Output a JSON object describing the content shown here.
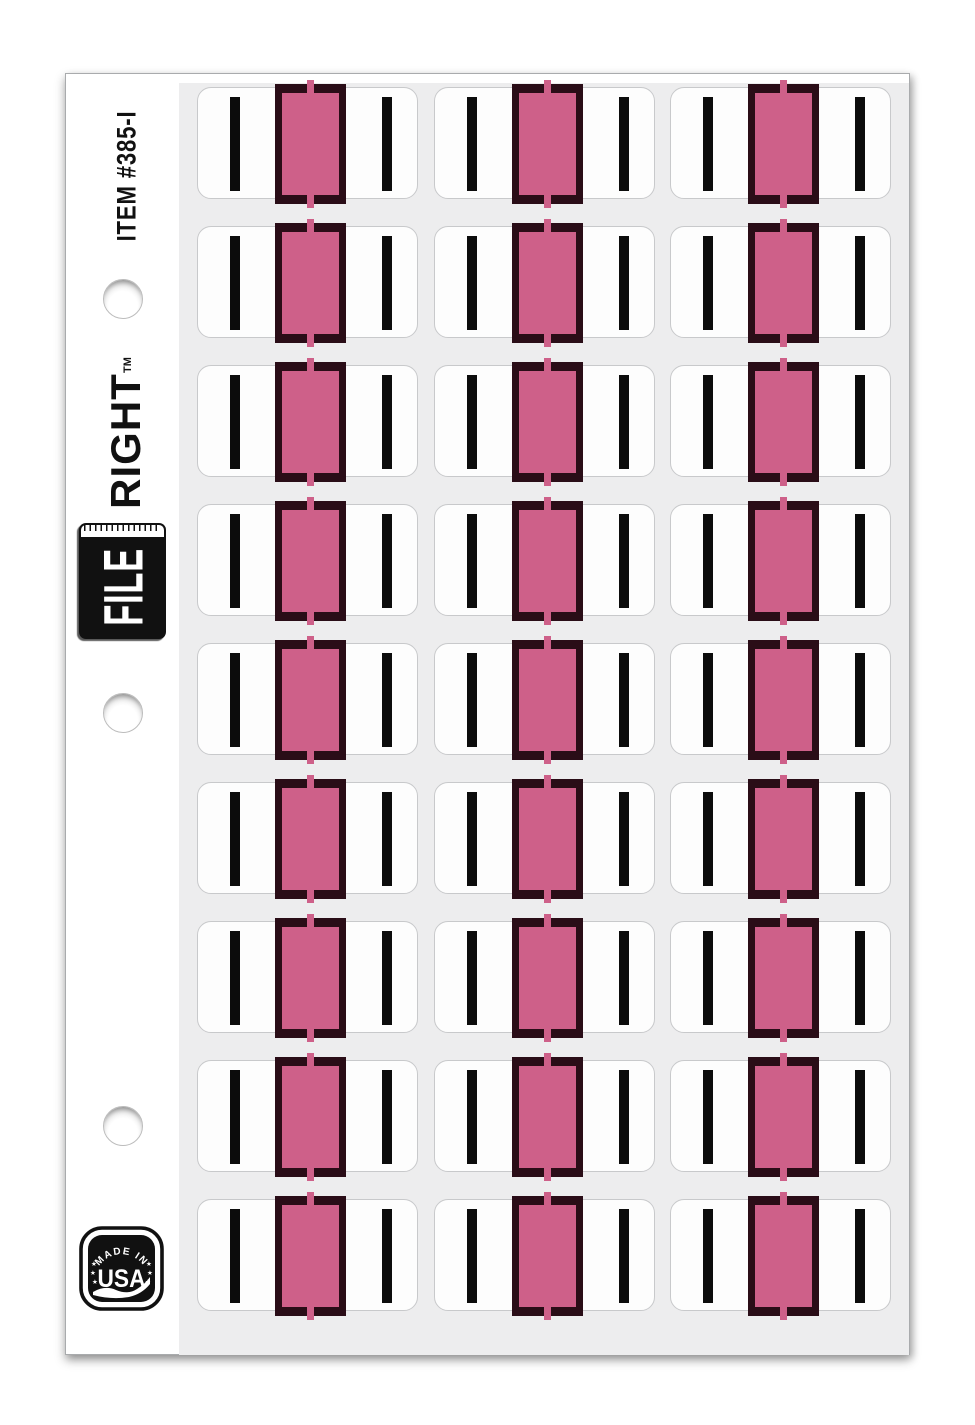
{
  "sheet": {
    "item_number": "ITEM #385-I",
    "brand": {
      "file_label": "FILE",
      "right_label": "RIGHT",
      "trademark": "TM"
    },
    "made_in_usa_badge": {
      "line1": "MADE IN",
      "line2": "USA"
    },
    "holes_count": 3,
    "grid": {
      "rows": 9,
      "columns": 3,
      "total_labels": 27
    },
    "label": {
      "letter": "I",
      "color_name": "pink",
      "colors": {
        "block": "#ce6089",
        "frame": "#2a0d17",
        "bar": "#0c0c0c",
        "label_bg": "#fdfdfd",
        "liner_bg": "#ededee"
      }
    }
  }
}
